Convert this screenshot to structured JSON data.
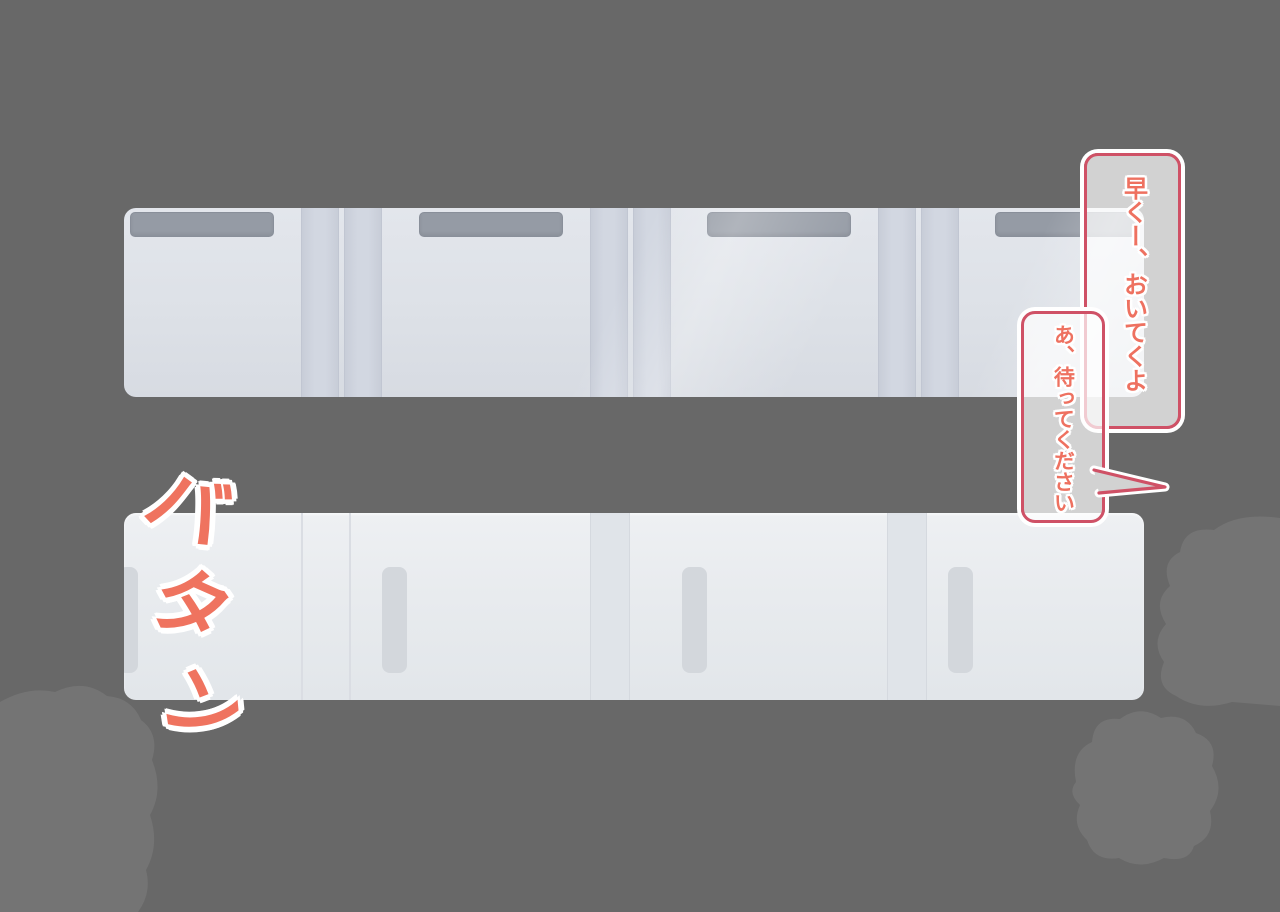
{
  "scene": {
    "background_color": "#686868",
    "sound_effect": {
      "text": "バタン",
      "chars": [
        "バ",
        "タ",
        "ン"
      ],
      "color": "#ef735f"
    },
    "speech_bubbles": [
      {
        "id": "bubble-1",
        "text": "早くー、おいてくよ",
        "text_color": "#ee7160",
        "border_color": "#cf5166",
        "fill": "rgba(255,255,255,0.70)",
        "orientation": "vertical"
      },
      {
        "id": "bubble-2",
        "text": "あ、待ってください",
        "text_color": "#ee7160",
        "border_color": "#cf5166",
        "fill": "rgba(255,255,255,0.70)",
        "orientation": "vertical"
      }
    ],
    "train": {
      "upper_car": {
        "window_count": 4,
        "door_stripe_count": 6,
        "base_color": "#dde1e7",
        "window_color": "#959ba5",
        "door_color": "#d2d7e1"
      },
      "lower_car": {
        "handle_count": 4,
        "door_column_count": 2,
        "base_color": "#e8ebee",
        "handle_color": "#d3d7dc"
      }
    },
    "dust_clouds": {
      "count": 3,
      "color": "#747474"
    }
  }
}
